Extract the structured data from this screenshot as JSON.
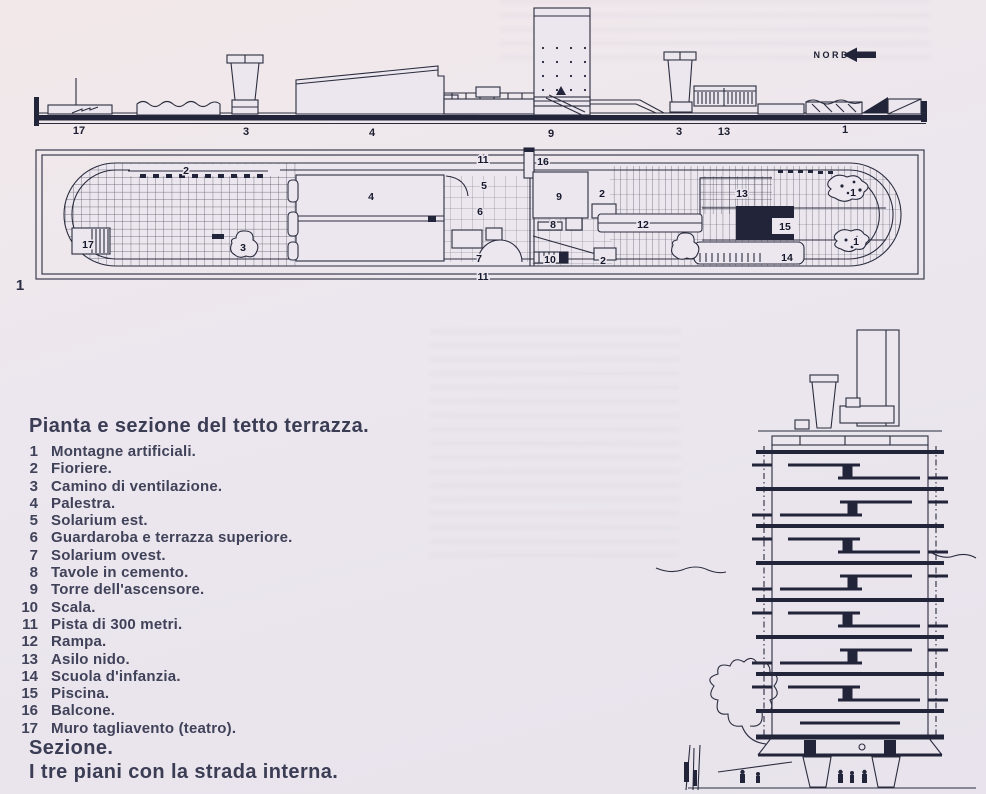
{
  "figure1": {
    "number": "1",
    "title": "Pianta e sezione del tetto terrazza.",
    "legend": [
      {
        "num": "1",
        "label": "Montagne artificiali."
      },
      {
        "num": "2",
        "label": "Fioriere."
      },
      {
        "num": "3",
        "label": "Camino di ventilazione."
      },
      {
        "num": "4",
        "label": "Palestra."
      },
      {
        "num": "5",
        "label": "Solarium est."
      },
      {
        "num": "6",
        "label": "Guardaroba e terrazza superiore."
      },
      {
        "num": "7",
        "label": "Solarium ovest."
      },
      {
        "num": "8",
        "label": "Tavole in cemento."
      },
      {
        "num": "9",
        "label": "Torre dell'ascensore."
      },
      {
        "num": "10",
        "label": "Scala."
      },
      {
        "num": "11",
        "label": "Pista di 300 metri."
      },
      {
        "num": "12",
        "label": "Rampa."
      },
      {
        "num": "13",
        "label": "Asilo nido."
      },
      {
        "num": "14",
        "label": "Scuola d'infanzia."
      },
      {
        "num": "15",
        "label": "Piscina."
      },
      {
        "num": "16",
        "label": "Balcone."
      },
      {
        "num": "17",
        "label": "Muro tagliavento (teatro)."
      }
    ]
  },
  "figure2": {
    "number": "2",
    "title": "Sezione."
  },
  "figure3": {
    "number": "3",
    "title": "I tre piani con la strada interna."
  },
  "north_label": "NORD",
  "ink_color": "#2a2c3e",
  "paper_color": "#ece7ee",
  "section_view": {
    "labels": [
      {
        "t": "17",
        "x": 79,
        "y": 134
      },
      {
        "t": "3",
        "x": 246,
        "y": 135
      },
      {
        "t": "4",
        "x": 372,
        "y": 136
      },
      {
        "t": "9",
        "x": 551,
        "y": 137
      },
      {
        "t": "3",
        "x": 679,
        "y": 135
      },
      {
        "t": "13",
        "x": 724,
        "y": 135
      },
      {
        "t": "1",
        "x": 845,
        "y": 133
      }
    ]
  },
  "plan_view": {
    "figure_label": "1",
    "labels": [
      {
        "t": "2",
        "x": 186,
        "y": 174
      },
      {
        "t": "17",
        "x": 88,
        "y": 248
      },
      {
        "t": "3",
        "x": 243,
        "y": 251
      },
      {
        "t": "4",
        "x": 371,
        "y": 200
      },
      {
        "t": "11",
        "x": 483,
        "y": 163
      },
      {
        "t": "16",
        "x": 543,
        "y": 165
      },
      {
        "t": "5",
        "x": 484,
        "y": 189
      },
      {
        "t": "6",
        "x": 480,
        "y": 215
      },
      {
        "t": "9",
        "x": 559,
        "y": 200
      },
      {
        "t": "2",
        "x": 602,
        "y": 197
      },
      {
        "t": "8",
        "x": 553,
        "y": 228
      },
      {
        "t": "12",
        "x": 643,
        "y": 228
      },
      {
        "t": "7",
        "x": 479,
        "y": 262
      },
      {
        "t": "10",
        "x": 550,
        "y": 263
      },
      {
        "t": "2",
        "x": 603,
        "y": 264
      },
      {
        "t": "13",
        "x": 742,
        "y": 197
      },
      {
        "t": "15",
        "x": 785,
        "y": 230
      },
      {
        "t": "14",
        "x": 787,
        "y": 261
      },
      {
        "t": "1",
        "x": 853,
        "y": 196
      },
      {
        "t": "1",
        "x": 856,
        "y": 245
      },
      {
        "t": "11",
        "x": 483,
        "y": 280
      }
    ]
  }
}
